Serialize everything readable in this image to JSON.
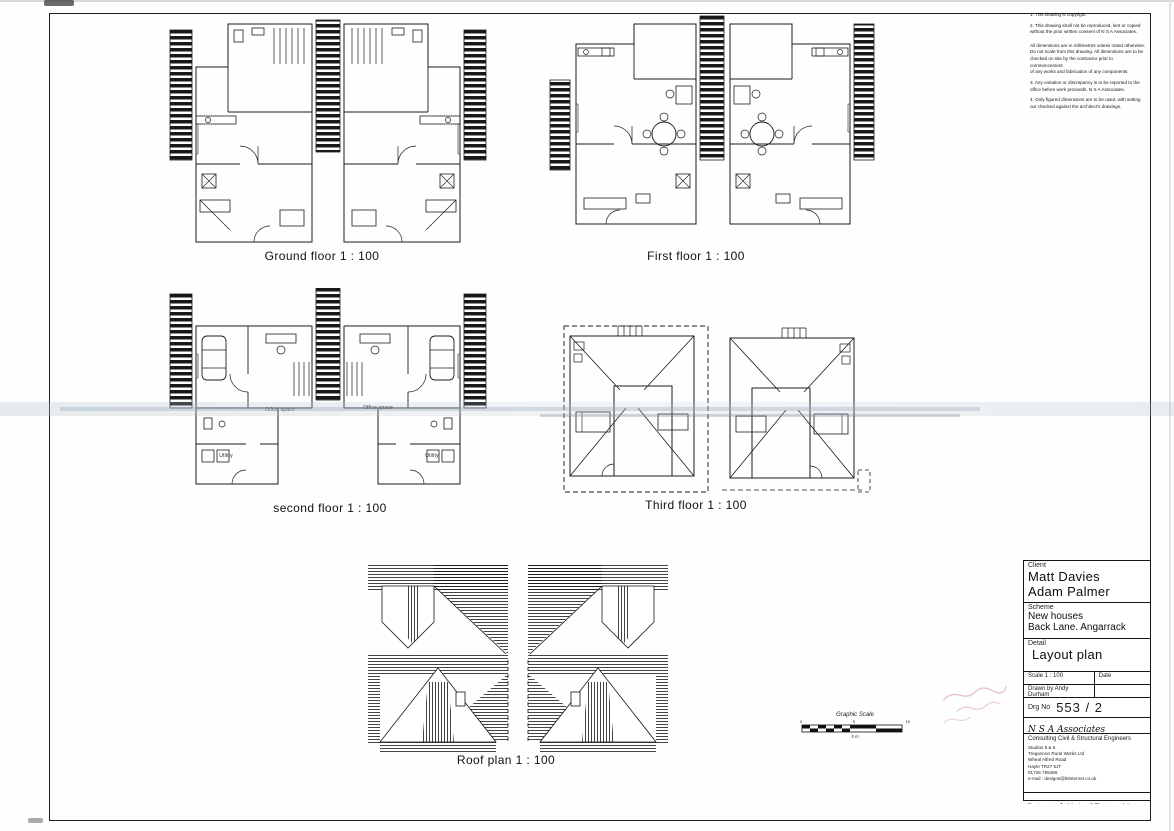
{
  "sheet": {
    "plan_labels": {
      "ground": "Ground floor  1 : 100",
      "first": "First floor  1 : 100",
      "second": "second floor  1 : 100",
      "third": "Third floor  1 : 100",
      "roof": "Roof plan  1 : 100"
    },
    "room_labels": {
      "office_space": "Office space",
      "utility": "Utility"
    }
  },
  "notes": {
    "items": [
      {
        "text": "1.  This drawing is copyright."
      },
      {
        "text": "2.  This drawing shall not be reproduced, lent or copied\n     without the prior written consent of N S A Associates.\n\n     All dimensions are in millimetres unless noted otherwise.\n     Do not scale from this drawing. All dimensions are to be\n     checked on site by the contractor prior to commencement\n     of any works and fabrication of any components."
      },
      {
        "text": "3.  Any variation or discrepancy is to be reported to the\n     office before work proceeds. N S A Associates."
      },
      {
        "text": "4.  Only figured dimensions are to be used, with setting\n     out checked against the architect's drawings."
      }
    ]
  },
  "graphic_scale": {
    "title": "Graphic Scale",
    "tick_left": "0",
    "tick_mid": "5",
    "tick_right": "10",
    "caption": "5 m"
  },
  "title_block": {
    "client_label": "Client",
    "client_line1": "Matt Davies",
    "client_line2": "Adam Palmer",
    "scheme_label": "Scheme",
    "scheme_line1": "New houses",
    "scheme_line2": "Back Lane. Angarrack",
    "detail_label": "Detail",
    "detail_value": "Layout plan",
    "scale_label": "Scale   1 : 100",
    "date_label": "Date",
    "drawn_label": "Drawn by    Andy Durham",
    "drg_no_label": "Drg No",
    "drg_no_value": "553 / 2",
    "firm_name": "N S A Associates",
    "firm_tagline": "Consulting Civil & Structural Engineers",
    "address_line1": "Studios 5 & 6",
    "address_line2": "Tregannon Rural Works Ltd",
    "address_line3": "Wheal Alfred Road",
    "address_line4": "Hayle TR27 5JT",
    "address_line5": "01736 755466",
    "address_line6": "e-mail : designs@btinternet.co.uk",
    "footer": "Engineering, Architecture & Planning solutions"
  }
}
